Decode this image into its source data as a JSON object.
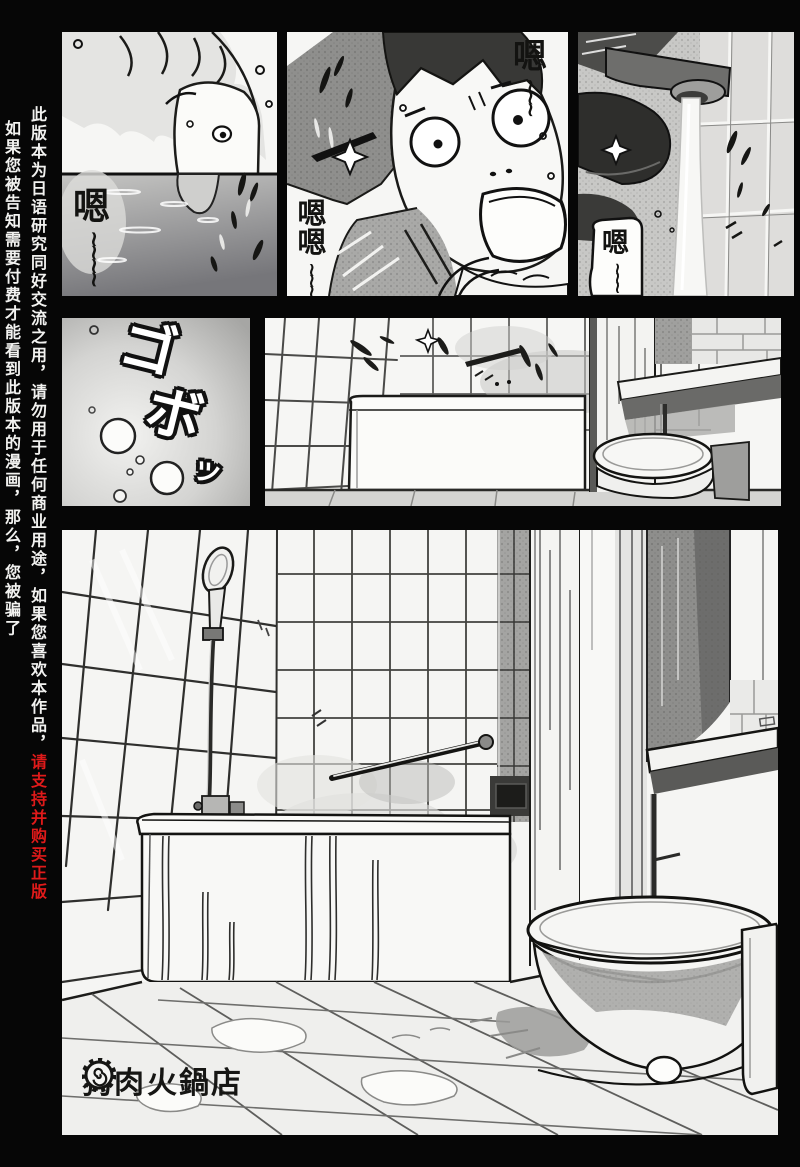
{
  "anti_piracy_notice": {
    "column_inner": {
      "text_white": "此版本为日语研究同好交流之用，请勿用于任何商业用途，如果您喜欢本作品，",
      "text_red": "请支持并购买正版",
      "red_color": "#e01a1a",
      "white_color": "#f2f2f0"
    },
    "column_outer": {
      "text": "如果您被告知需要付费才能看到此版本的漫画，那么，您被骗了"
    }
  },
  "panels": {
    "panel1": {
      "sfx": "嗯",
      "sfx_wave": "~~~~"
    },
    "panel2": {
      "sfx_top": "嗯",
      "sfx_top_wave": "~~~",
      "sfx_bottom": "嗯嗯",
      "sfx_bottom_wave": "~~~"
    },
    "panel3": {
      "speech": "嗯",
      "speech_wave": "~~~"
    },
    "panel4": {
      "sfx_chars": [
        "ゴ",
        "ボ",
        "ッ"
      ]
    }
  },
  "watermark": {
    "prefix": "狗肉",
    "suffix": "火鍋店"
  }
}
